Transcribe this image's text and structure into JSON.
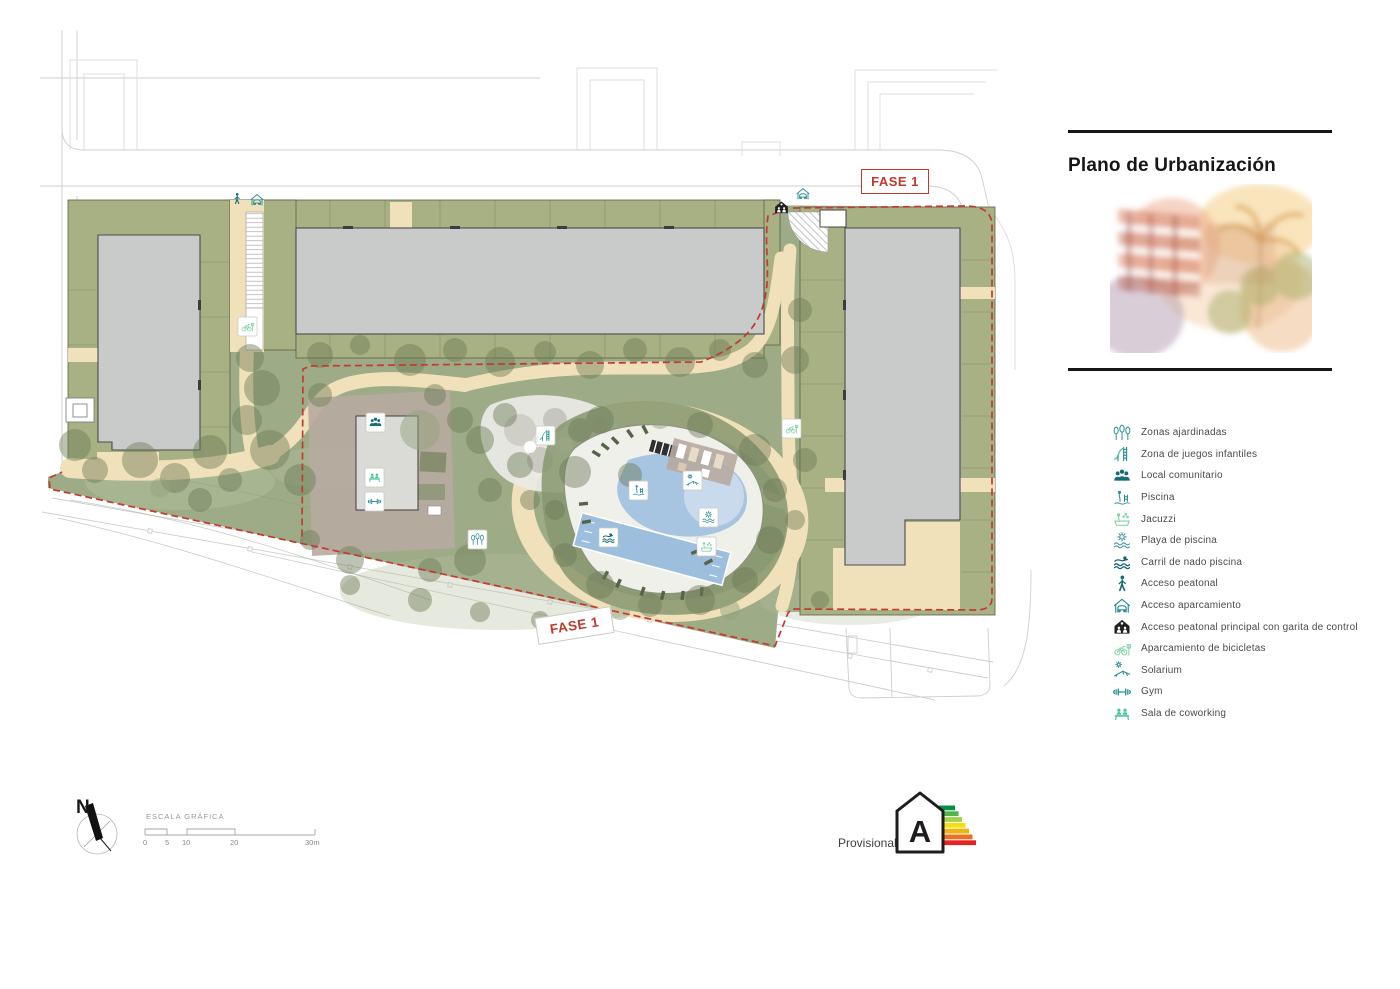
{
  "title_block": {
    "title": "Plano de Urbanización"
  },
  "phase_labels": {
    "top": "FASE 1",
    "bottom": "FASE 1"
  },
  "legend": {
    "items": [
      {
        "icon": "trees-icon",
        "label": "Zonas ajardinadas"
      },
      {
        "icon": "playground-slide-icon",
        "label": "Zona de juegos infantiles"
      },
      {
        "icon": "people-group-icon",
        "label": "Local comunitario"
      },
      {
        "icon": "pool-ladder-icon",
        "label": "Piscina"
      },
      {
        "icon": "jacuzzi-icon",
        "label": "Jacuzzi"
      },
      {
        "icon": "sun-waves-icon",
        "label": "Playa de piscina"
      },
      {
        "icon": "swimmer-icon",
        "label": "Carril de nado piscina"
      },
      {
        "icon": "pedestrian-icon",
        "label": "Acceso peatonal"
      },
      {
        "icon": "garage-icon",
        "label": "Acceso aparcamiento"
      },
      {
        "icon": "guardhouse-icon",
        "label": "Acceso peatonal principal con garita de control"
      },
      {
        "icon": "bicycle-parking-icon",
        "label": "Aparcamiento de bicicletas"
      },
      {
        "icon": "sun-lounger-icon",
        "label": "Solarium"
      },
      {
        "icon": "dumbbell-icon",
        "label": "Gym"
      },
      {
        "icon": "coworking-icon",
        "label": "Sala de coworking"
      }
    ]
  },
  "compass": {
    "label": "N"
  },
  "scale_bar": {
    "title": "ESCALA GRÁFICA",
    "ticks": [
      "0",
      "5",
      "10",
      "20",
      "30m"
    ]
  },
  "energy": {
    "status": "Provisional",
    "rating": "A",
    "bar_colors": [
      "#029347",
      "#4fb548",
      "#a5d04a",
      "#f4e00f",
      "#f0b310",
      "#ea7025",
      "#e52321"
    ]
  },
  "colors": {
    "phase_red": "#c0392b",
    "teal": "#2a8f96",
    "teal_dark": "#0f6272",
    "green_light": "#7fd3a8",
    "lawn_green": "#9dab87",
    "band_olive": "#a8b183",
    "path_beige": "#f1e1ba",
    "building_gray": "#c9caca",
    "pool_blue": "#a7c4e1",
    "paving_mauve": "#b7aaa0"
  }
}
